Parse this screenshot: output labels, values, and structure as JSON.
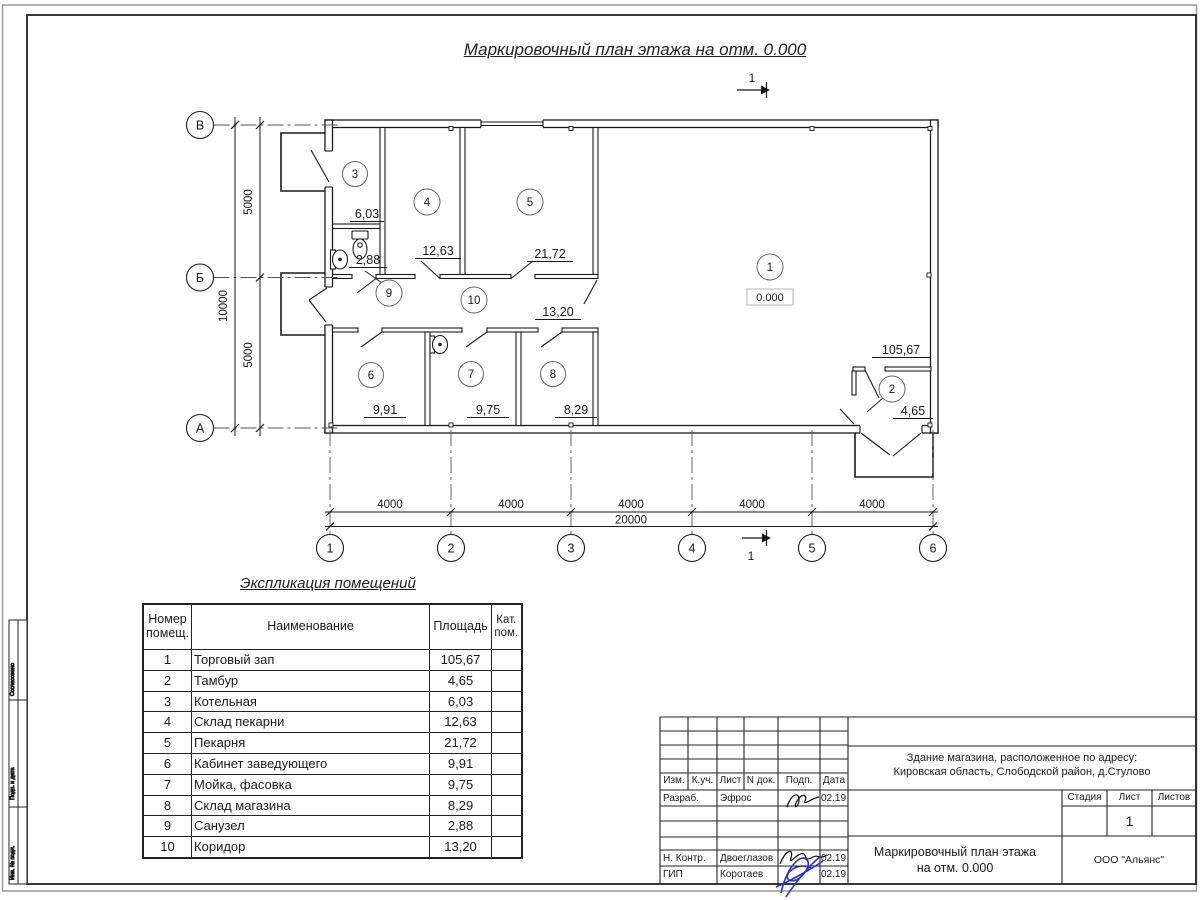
{
  "sheet": {
    "plan_title": "Маркировочный план этажа на отм. 0.000",
    "section_mark": "1"
  },
  "plan": {
    "elevation": "0.000",
    "rooms": [
      {
        "num": "1",
        "area": "105,67"
      },
      {
        "num": "2",
        "area": "4,65"
      },
      {
        "num": "3",
        "area": "6,03"
      },
      {
        "num": "4",
        "area": "12,63"
      },
      {
        "num": "5",
        "area": "21,72"
      },
      {
        "num": "6",
        "area": "9,91"
      },
      {
        "num": "7",
        "area": "9,75"
      },
      {
        "num": "8",
        "area": "8,29"
      },
      {
        "num": "9",
        "area": "2,88"
      },
      {
        "num": "10",
        "area": "13,20"
      }
    ]
  },
  "axes": {
    "cols": [
      "1",
      "2",
      "3",
      "4",
      "5",
      "6"
    ],
    "rows": [
      "В",
      "Б",
      "А"
    ]
  },
  "dims": {
    "col_segments": [
      "4000",
      "4000",
      "4000",
      "4000",
      "4000"
    ],
    "col_total": "20000",
    "row_segments": [
      "5000",
      "5000"
    ],
    "row_total": "10000"
  },
  "explication": {
    "title": "Экспликация помещений",
    "col_num": "Номер помещ.",
    "col_name": "Наименование",
    "col_area": "Площадь",
    "col_cat": "Кат. пом.",
    "rows": [
      {
        "num": "1",
        "name": "Торговый зап",
        "area": "105,67",
        "cat": ""
      },
      {
        "num": "2",
        "name": "Тамбур",
        "area": "4,65",
        "cat": ""
      },
      {
        "num": "3",
        "name": "Котельная",
        "area": "6,03",
        "cat": ""
      },
      {
        "num": "4",
        "name": "Склад пекарни",
        "area": "12,63",
        "cat": ""
      },
      {
        "num": "5",
        "name": "Пекарня",
        "area": "21,72",
        "cat": ""
      },
      {
        "num": "6",
        "name": "Кабинет заведующего",
        "area": "9,91",
        "cat": ""
      },
      {
        "num": "7",
        "name": "Мойка, фасовка",
        "area": "9,75",
        "cat": ""
      },
      {
        "num": "8",
        "name": "Склад магазина",
        "area": "8,29",
        "cat": ""
      },
      {
        "num": "9",
        "name": "Санузел",
        "area": "2,88",
        "cat": ""
      },
      {
        "num": "10",
        "name": "Коридор",
        "area": "13,20",
        "cat": ""
      }
    ]
  },
  "title_block": {
    "header": {
      "izm": "Изм.",
      "kuch": "К.уч.",
      "list": "Лист",
      "ndok": "N док.",
      "podp": "Подп.",
      "data": "Дата"
    },
    "rows": [
      {
        "role": "Разраб.",
        "name": "Эфрос",
        "date": "02.19"
      },
      {
        "role": "Н. Контр.",
        "name": "Двоеглазов",
        "date": "02.19"
      },
      {
        "role": "ГИП",
        "name": "Коротаев",
        "date": "02.19"
      }
    ],
    "address_line1": "Здание магазина, расположенное по адресу:",
    "address_line2": "Кировская область, Слободской район, д.Стулово",
    "doc_title_line1": "Маркировочный план этажа",
    "doc_title_line2": "на отм. 0.000",
    "company": "ООО \"Альянс\"",
    "stage_label": "Стадия",
    "sheet_label": "Лист",
    "sheets_label": "Листов",
    "sheet_number": "1"
  },
  "side_stamp": {
    "cell1": "Согласовано",
    "cell2": "Подп. и дата",
    "cell3": "Инв. № подл."
  }
}
